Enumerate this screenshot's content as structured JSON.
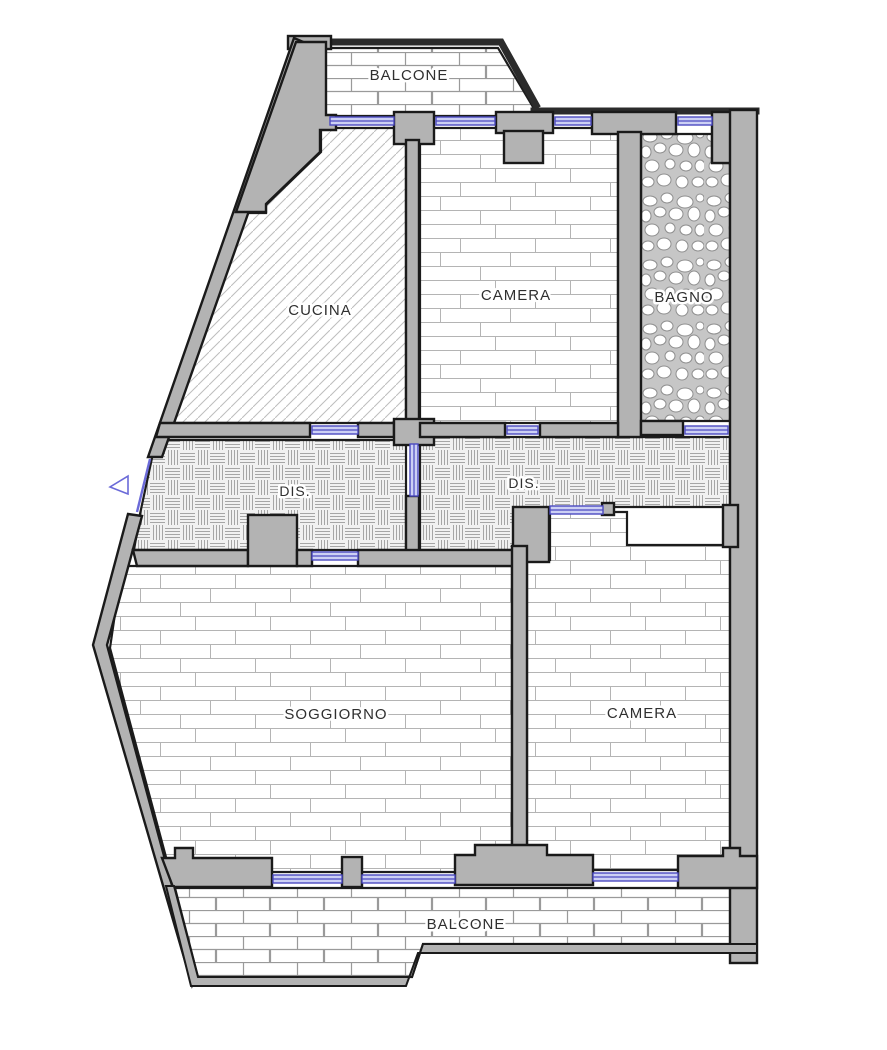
{
  "diagram": {
    "type": "apartment-floor-plan",
    "language": "italian"
  },
  "rooms": [
    {
      "id": "balcone-top",
      "label": "BALCONE"
    },
    {
      "id": "cucina",
      "label": "CUCINA"
    },
    {
      "id": "camera-top",
      "label": "CAMERA"
    },
    {
      "id": "bagno",
      "label": "BAGNO"
    },
    {
      "id": "dis-left",
      "label": "DIS."
    },
    {
      "id": "dis-right",
      "label": "DIS."
    },
    {
      "id": "soggiorno",
      "label": "SOGGIORNO"
    },
    {
      "id": "camera-bottom",
      "label": "CAMERA"
    },
    {
      "id": "balcone-bottom",
      "label": "BALCONE"
    }
  ],
  "legend": {
    "wall_color": "#b3b3b3",
    "outline_color": "#1a1a1a",
    "window_color": "#4b4ac0",
    "background_color": "#ffffff"
  }
}
